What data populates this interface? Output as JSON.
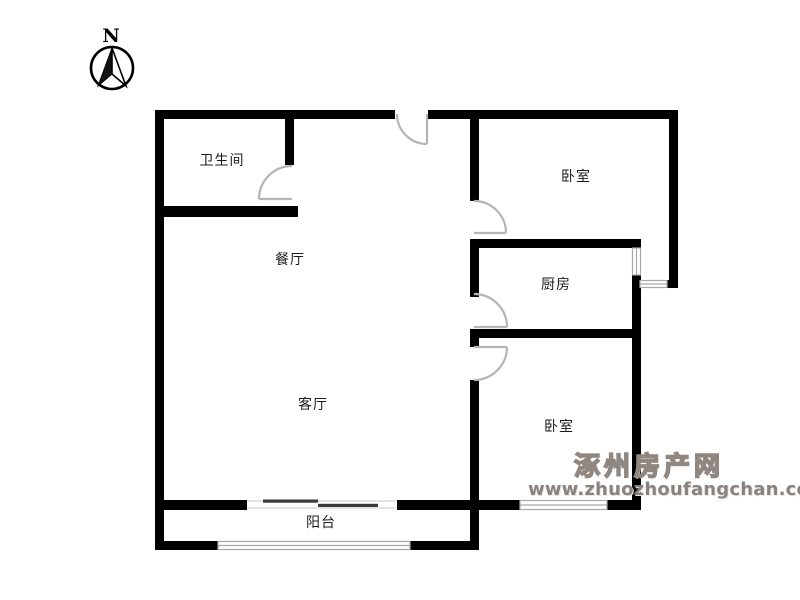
{
  "compass": {
    "label": "N"
  },
  "rooms": [
    {
      "id": "bathroom",
      "label": "卫生间"
    },
    {
      "id": "dining",
      "label": "餐厅"
    },
    {
      "id": "living",
      "label": "客厅"
    },
    {
      "id": "bedroom-north",
      "label": "卧室"
    },
    {
      "id": "kitchen",
      "label": "厨房"
    },
    {
      "id": "bedroom-south",
      "label": "卧室"
    },
    {
      "id": "balcony",
      "label": "阳台"
    }
  ],
  "watermark": {
    "site_name": "涿州房产网",
    "site_url": "www.zhuozhoufangchan.com"
  },
  "colors": {
    "wall": "#000000",
    "door_arc": "#b5b5b5",
    "window_line": "#a8a8a8",
    "watermark_gray": "#8f8780",
    "background": "#ffffff"
  }
}
